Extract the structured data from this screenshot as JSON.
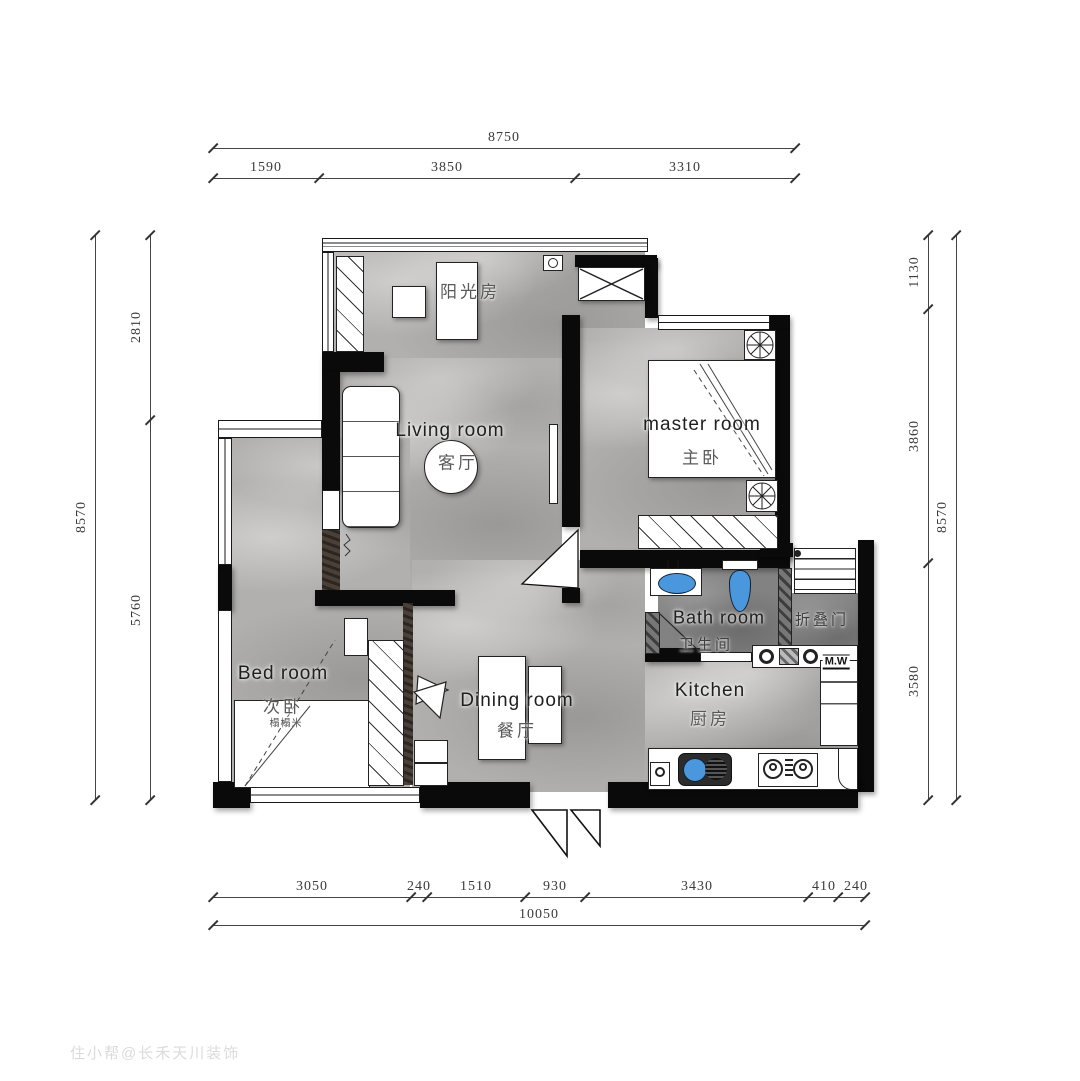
{
  "title": "两室户型平面布置图",
  "watermark": "住小帮@长禾天川装饰",
  "dims": {
    "top": {
      "total": "8750",
      "segments": [
        "1590",
        "3850",
        "3310"
      ]
    },
    "left": {
      "total": "8570",
      "segments": [
        "2810",
        "5760"
      ]
    },
    "right": {
      "total": "8570",
      "segments": [
        "1130",
        "3860",
        "3580"
      ]
    },
    "bottom": {
      "total": "10050",
      "segments": [
        "3050",
        "240",
        "1510",
        "930",
        "3430",
        "410",
        "240"
      ]
    }
  },
  "rooms": {
    "sunroom": {
      "cn": "阳光房"
    },
    "living": {
      "en": "Living room",
      "cn": "客厅"
    },
    "master": {
      "en": "master room",
      "cn": "主卧"
    },
    "bedroom": {
      "en": "Bed room",
      "cn": "次卧",
      "note": "榻榻米"
    },
    "dining": {
      "en": "Dining room",
      "cn": "餐厅"
    },
    "bath": {
      "en": "Bath room",
      "cn": "卫生间"
    },
    "kitchen": {
      "en": "Kitchen",
      "cn": "厨房"
    },
    "laundry": {
      "folding_door": "折叠门",
      "microwave": "M.W"
    }
  },
  "colors": {
    "wall": "#0a0a0a",
    "floor": "#b1b0ae",
    "floor_dark": "#828282",
    "fixture_blue": "#4a97dd"
  }
}
